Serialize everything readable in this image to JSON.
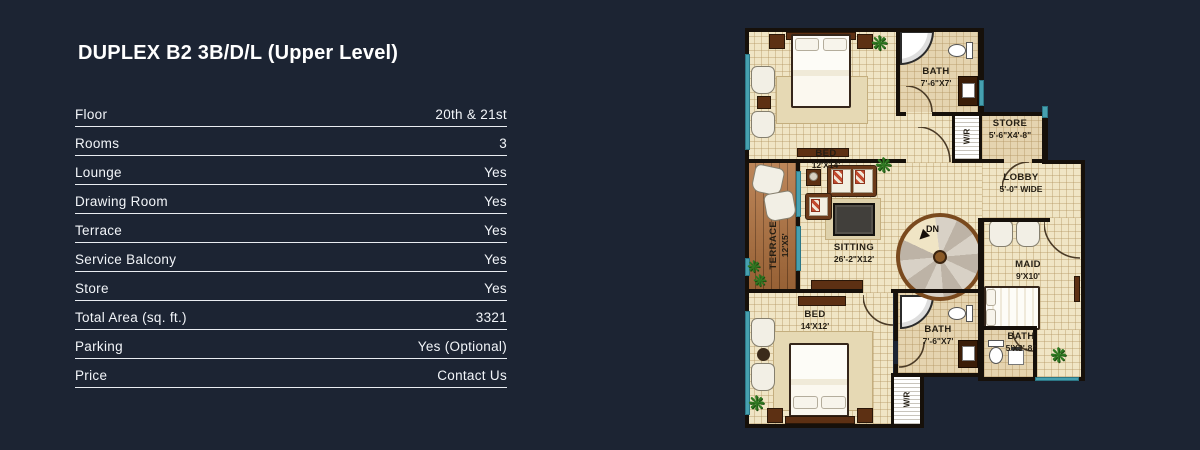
{
  "palette": {
    "background": "#1c2433",
    "text": "#f2f5f9",
    "rule": "#e9edf2",
    "floor": "#f0e5c5",
    "floor_dark": "#e5d4b0",
    "wall": "#16100a",
    "window_glass": "#46a0b0",
    "terrace_wood": "#b2723e",
    "plant_green": "#2f7a22"
  },
  "header": {
    "title": "DUPLEX B2 3B/D/L (Upper Level)"
  },
  "specs": [
    {
      "label": "Floor",
      "value": "20th & 21st"
    },
    {
      "label": "Rooms",
      "value": "3"
    },
    {
      "label": "Lounge",
      "value": "Yes"
    },
    {
      "label": "Drawing Room",
      "value": "Yes"
    },
    {
      "label": "Terrace",
      "value": "Yes"
    },
    {
      "label": "Service Balcony",
      "value": "Yes"
    },
    {
      "label": "Store",
      "value": "Yes"
    },
    {
      "label": "Total Area (sq. ft.)",
      "value": "3321"
    },
    {
      "label": "Parking",
      "value": "Yes (Optional)"
    },
    {
      "label": "Price",
      "value": "Contact Us"
    }
  ],
  "plan": {
    "icons": {
      "plant": "❋"
    },
    "stair": {
      "label": "DN"
    },
    "rooms": {
      "bed1": {
        "name": "BED",
        "dim": "12'X14'"
      },
      "bath1": {
        "name": "BATH",
        "dim": "7'-6\"X7'"
      },
      "wr1": {
        "name": "W/R"
      },
      "store": {
        "name": "STORE",
        "dim": "5'-6\"X4'-8\""
      },
      "lobby": {
        "name": "LOBBY",
        "dim": "5'-0\" WIDE"
      },
      "terrace": {
        "name": "TERRACE",
        "dim": "12'X5'"
      },
      "sitting": {
        "name": "SITTING",
        "dim": "26'-2\"X12'"
      },
      "maid": {
        "name": "MAID",
        "dim": "9'X10'"
      },
      "bed2": {
        "name": "BED",
        "dim": "14'X12'"
      },
      "bath2": {
        "name": "BATH",
        "dim": "7'-6\"X7'"
      },
      "maid_bath": {
        "name": "BATH",
        "dim": "5'X3'-8\""
      },
      "wr2": {
        "name": "W/R"
      }
    }
  }
}
